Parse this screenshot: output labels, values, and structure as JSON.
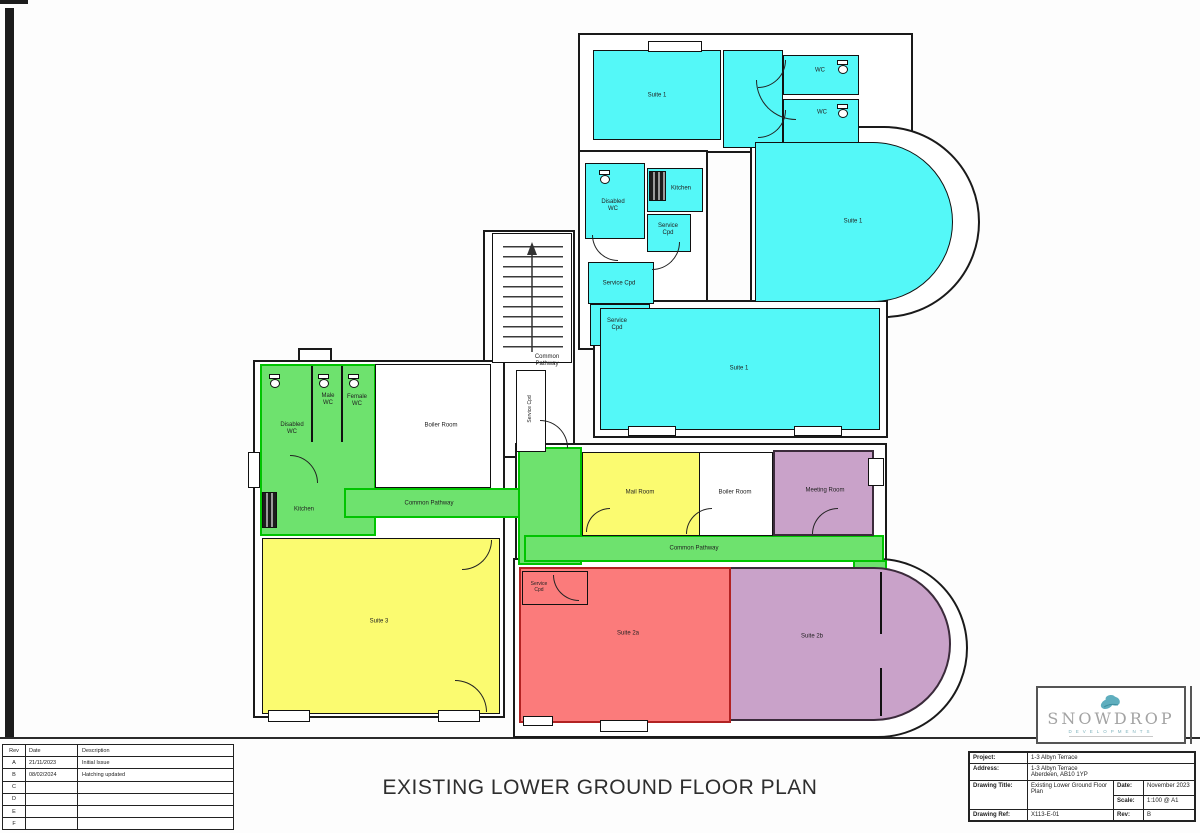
{
  "page": {
    "title": "EXISTING LOWER GROUND FLOOR PLAN"
  },
  "colors": {
    "suite_cyan": "#54f8f8",
    "pathway_green": "#6ee26e",
    "suite_yellow": "#fbfb70",
    "suite_red": "#fb7b7b",
    "suite_purple": "#c9a2c9",
    "wall_black": "#111111",
    "logo_teal": "#5faebe"
  },
  "plan": {
    "labels": {
      "suite1_topleft": "Suite 1",
      "wc_top": "WC",
      "wc_bottom": "WC",
      "suite1_main": "Suite 1",
      "suite1_mid": "Suite 1",
      "disabled_wc_cyan": "Disabled\nWC",
      "kitchen_cyan": "Kitchen",
      "service_cpd_a": "Service\nCpd",
      "service_cpd_b": "Service Cpd",
      "service_cpd_c": "Service\nCpd",
      "common_pathway_stairs": "Common\nPathway",
      "service_cpd_vert": "Service Cpd",
      "disabled_wc_green": "Disabled\nWC",
      "male_wc": "Male\nWC",
      "female_wc": "Female\nWC",
      "kitchen_green": "Kitchen",
      "common_pathway_left": "Common Pathway",
      "boiler_left": "Boiler Room",
      "mail_room": "Mail Room",
      "boiler_mid": "Boiler Room",
      "meeting_room": "Meeting Room",
      "common_pathway_long": "Common Pathway",
      "suite3": "Suite 3",
      "suite2a": "Suite 2a",
      "suite2b": "Suite 2b",
      "service_cpd_red": "Service\nCpd"
    }
  },
  "revisions": {
    "headers": [
      "Rev",
      "Date",
      "Description"
    ],
    "rows": [
      {
        "rev": "A",
        "date": "21/11/2023",
        "desc": "Initial Issue"
      },
      {
        "rev": "B",
        "date": "08/02/2024",
        "desc": "Hatching updated"
      },
      {
        "rev": "C",
        "date": "",
        "desc": ""
      },
      {
        "rev": "D",
        "date": "",
        "desc": ""
      },
      {
        "rev": "E",
        "date": "",
        "desc": ""
      },
      {
        "rev": "F",
        "date": "",
        "desc": ""
      }
    ]
  },
  "logo": {
    "name": "SNOWDROP",
    "subtitle": "DEVELOPMENTS"
  },
  "title_block": {
    "project_label": "Project:",
    "project": "1-3 Albyn Terrace",
    "address_label": "Address:",
    "address": "1-3 Albyn Terrace\nAberdeen, AB10 1YP",
    "drawing_title_label": "Drawing Title:",
    "drawing_title": "Existing Lower Ground Floor Plan",
    "date_label": "Date:",
    "date": "November 2023",
    "scale_label": "Scale:",
    "scale": "1:100 @ A1",
    "drawing_ref_label": "Drawing Ref:",
    "drawing_ref": "X113-E-01",
    "rev_label": "Rev:",
    "rev": "B"
  }
}
